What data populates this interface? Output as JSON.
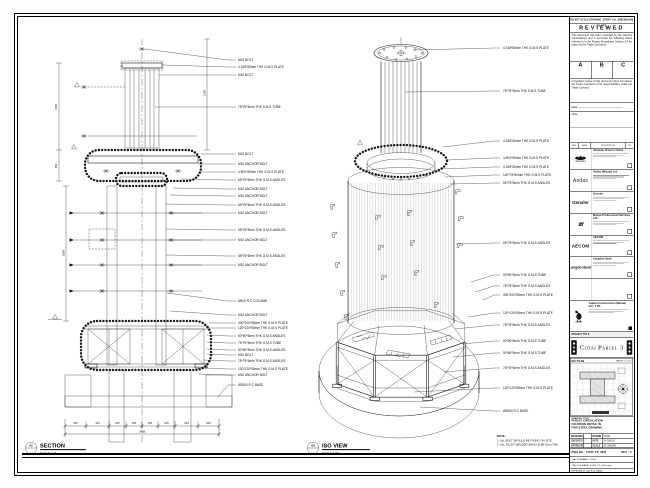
{
  "section": {
    "title": "SECTION",
    "scale": "SCALE 1:25",
    "bubble_no": "02",
    "bubble_ref": "-",
    "labels": [
      "M10 BOLT",
      "4 345*50mm THK G.M.S PLATE",
      "M10 BOLT",
      "75*75*5mm THK S.M.S TUBE",
      "M10 BOLT",
      "M10 ANCHOR BOLT",
      "4 800*50mm THK G.M.S PLATE",
      "65*75*5mm THK G.M.S ANGLES",
      "M10 ANCHOR BOLT",
      "M10 ANCHOR BOLT",
      "65*75*5mm THK G.M.S ANGLES",
      "M10 ANCHOR BOLT",
      "65*75*5mm THK G.M.S ANGLES",
      "M10 ANCHOR BOLT",
      "65*75*5mm THK G.M.S ANGLES",
      "M10 ANCHOR BOLT",
      "Ø500 R.C COLUMN",
      "M10 ANCHOR BOLT",
      "400*200*50mm THK G.M.S PLATE",
      "120*120*50mm THK G.M.S PLATE",
      "50*50*5mm THK G.M.S ANGLES",
      "75*75*5mm THK G.M.S TUBE",
      "50*50*5mm THK G.M.S ANGLES",
      "M10 BOLT",
      "75*75*5mm THK G.M.S ANGLES",
      "120*120*50mm THK G.M.S PLATE",
      "M10 ANCHOR BOLT",
      "Ø2500 R.C BASE"
    ],
    "vdims": [
      "1500",
      "450",
      "1800",
      "1500"
    ],
    "dims": [
      "300",
      "444",
      "225",
      "250",
      "250",
      "225",
      "444",
      "300"
    ],
    "dim_total": "2438"
  },
  "iso": {
    "title": "ISO VIEW",
    "scale": "SCALE 1:25",
    "bubble_no": "03",
    "bubble_ref": "-",
    "labels": [
      "4 345*50mm THK G.M.S PLATE",
      "75*75*5mm THK S.M.S TUBE",
      "4 345*50mm THK G.M.S PLATE",
      "4 800*50mm THK G.M.S PLATE",
      "4 345*50mm THK G.M.S PLATE",
      "120*75*50mm THK G.M.S PLATE",
      "65*75*5mm THK G.M.S ANGLES",
      "65*75*5mm THK G.M.S ANGLES",
      "50*50*5mm THK G.M.S TUBE",
      "75*75*5mm THK G.M.S ANGLES",
      "400*200*50mm THK G.M.S PLATE",
      "120*120*50mm THK G.M.S PLATE",
      "75*75*5mm THK G.M.S ANGLES",
      "50*50*5mm THK G.M.S TUBE",
      "50*50*5mm THK G.M.S TUBE",
      "75*75*5mm THK G.M.S ANGLES",
      "120*120*50mm THK G.M.S PLATE",
      "Ø2500 R.C BASE"
    ],
    "note_title": "NOTE:",
    "notes": [
      "1. ALL BOLT SHOULD BE FIXING ON SITE.",
      "2. ALL FILLET WELDED SHOULD BE 6mm THK."
    ]
  },
  "titleblock": {
    "top_note": "DO NOT SCALE DRAWING. VERIFY ALL DIMENSIONS ON SITE.",
    "reviewed": {
      "title": "REVIEWED",
      "para1": "This document has been reviewed by the relevant Consultant(s) and is accorded the following status referred to in the Project Procedures Section 5.4 for action by the Trade Contractor.",
      "options": [
        "A",
        "B",
        "C"
      ],
      "para2": "Consultant review of this document does not relieve the Trade Contractor of its responsibilities under the Trade Contract.",
      "date_label": "Date :"
    },
    "note_label": "Note :",
    "rev_header": [
      "REV",
      "DATE",
      "DESCRIPTION",
      "BY"
    ],
    "consultants": [
      {
        "logo_text": "Venetian",
        "name": "Venetian Orient Limited"
      },
      {
        "logo_text": "Aedas",
        "name": "Aedas (Macau) Ltd."
      },
      {
        "logo_text": "Gensler",
        "name": "Gensler"
      },
      {
        "logo_text": "ttt",
        "name": "Macau Professional Services Ltd."
      },
      {
        "logo_text": "AECOM",
        "name": "AECOM"
      },
      {
        "logo_text": "LangdonSeah",
        "name": "Langdon Seah"
      },
      {
        "logo_text": "",
        "name": ""
      }
    ],
    "contractor": {
      "name": "Yadea Construction (Macau) CO., LTD."
    },
    "project_title_label": "PROJECT TITLE",
    "project_title": "Cotai Parcel 3",
    "key_plan": {
      "label": "KEY PLAN",
      "sublabel": "PARCEL 1, LOT 2"
    },
    "drawing_title_label": "DRAWING TITLE :",
    "drawing_title_lines": [
      "PUBLIC CIRCULATION",
      "FOUNTAIN DETAIL IN",
      "FOR STEEL DRAWING"
    ],
    "fields": {
      "designed_label": "DESIGNED",
      "designed": "-",
      "drawn_label": "DRAWN",
      "drawn": "CHAD",
      "checked_label": "CHECKED",
      "checked": "-",
      "date_label": "DATE",
      "date": "14-JUN-10",
      "approved_label": "APPROVED",
      "approved": "-",
      "scale_label": "SCALE",
      "scale": "AS SHOWN"
    },
    "dwg_no_label": "DWG NO :",
    "dwg_no": "51535_PS_0000",
    "rev_label": "REV :",
    "rev": "C",
    "cad_rows": [
      "CAD FILENAME : 51535",
      "CAD FILE NAME : 51535_PS_0000.dwg",
      "REFERENCE CAD FILE NAME :"
    ]
  }
}
